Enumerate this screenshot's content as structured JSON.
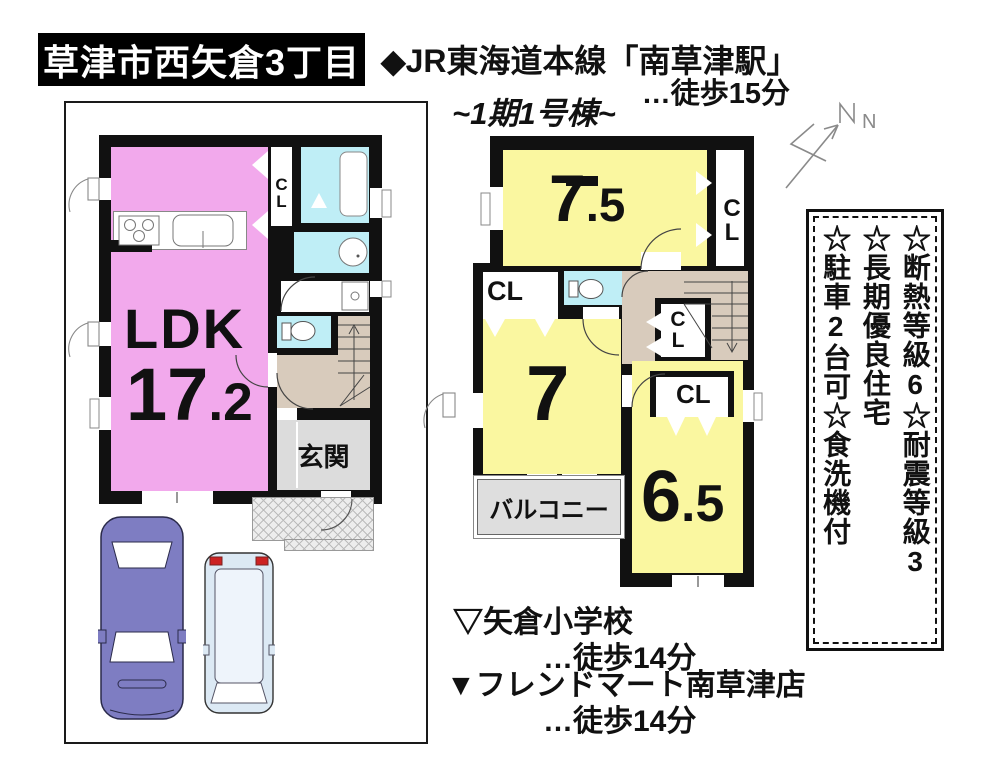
{
  "header": {
    "location_box": "草津市西矢倉3丁目",
    "rail_line": "◆JR東海道本線「南草津駅」",
    "rail_walk": "…徒歩15分",
    "building": "~1期1号棟~",
    "north": "N"
  },
  "floor1": {
    "ldk": "LDK",
    "ldk_area_int": "17",
    "ldk_area_dec": ".2",
    "entrance": "玄関"
  },
  "floor2": {
    "room_a_int": "7",
    "room_a_dec": ".5",
    "room_b": "7",
    "room_c_int": "6",
    "room_c_dec": ".5",
    "balcony": "バルコニー"
  },
  "labels": {
    "closet": "CL"
  },
  "features": {
    "col1": "☆断熱等級6☆耐震等級3",
    "col2": "☆長期優良住宅",
    "col3": "☆駐車2台可☆食洗機付"
  },
  "footer": {
    "school": "▽矢倉小学校",
    "school_walk": "…徒歩14分",
    "store": "▼フレンドマート南草津店",
    "store_walk": "…徒歩14分"
  },
  "colors": {
    "room_pink": "#f2a9ec",
    "room_yellow": "#faf7a0",
    "wet_cyan": "#bfeef6",
    "stairs_tan": "#d8cbbc",
    "entrance_gray": "#dcdcdc",
    "balcony_gray": "#dedede",
    "car_purple": "#7e7dc2",
    "car_blue": "#dce9f4"
  }
}
